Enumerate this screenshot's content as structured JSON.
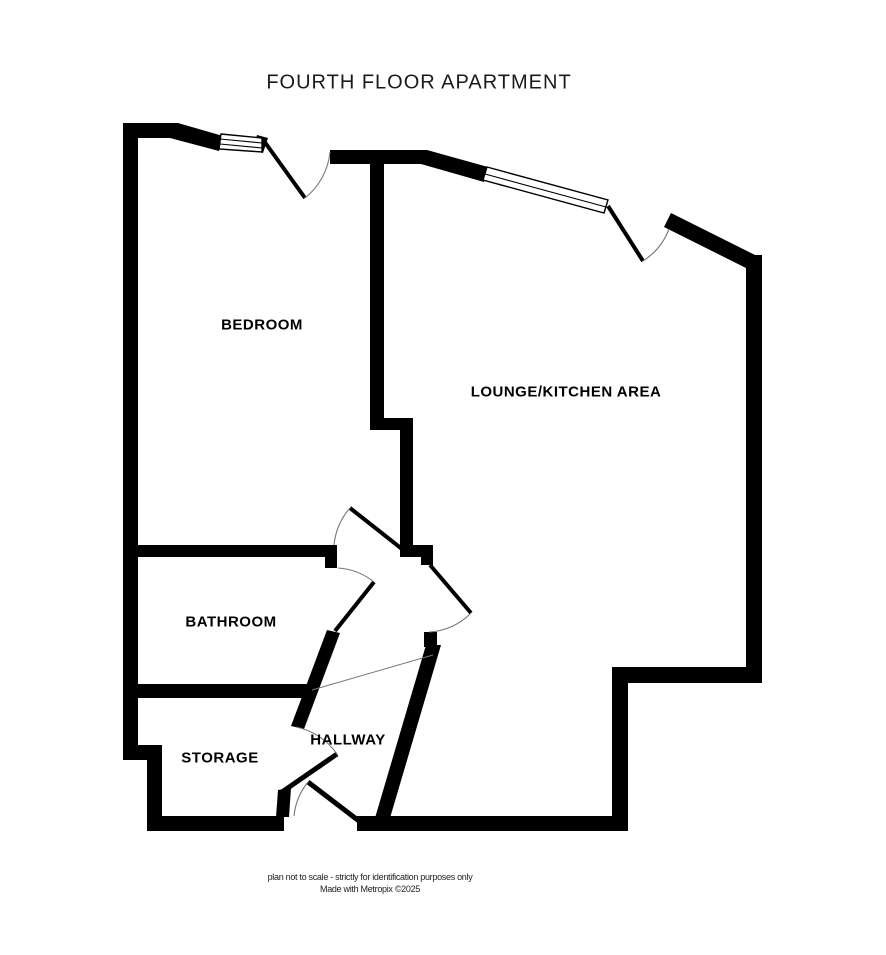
{
  "title": "FOURTH FLOOR APARTMENT",
  "rooms": {
    "bedroom": {
      "label": "BEDROOM"
    },
    "lounge": {
      "label": "LOUNGE/KITCHEN AREA"
    },
    "bathroom": {
      "label": "BATHROOM"
    },
    "storage": {
      "label": "STORAGE"
    },
    "hallway": {
      "label": "HALLWAY"
    }
  },
  "footer": {
    "line1": "plan not to scale - strictly for identification purposes only",
    "line2": "Made with Metropix ©2025"
  },
  "colors": {
    "wall": "#000000",
    "background": "#ffffff",
    "door_arc": "#777777",
    "text": "#000000"
  }
}
